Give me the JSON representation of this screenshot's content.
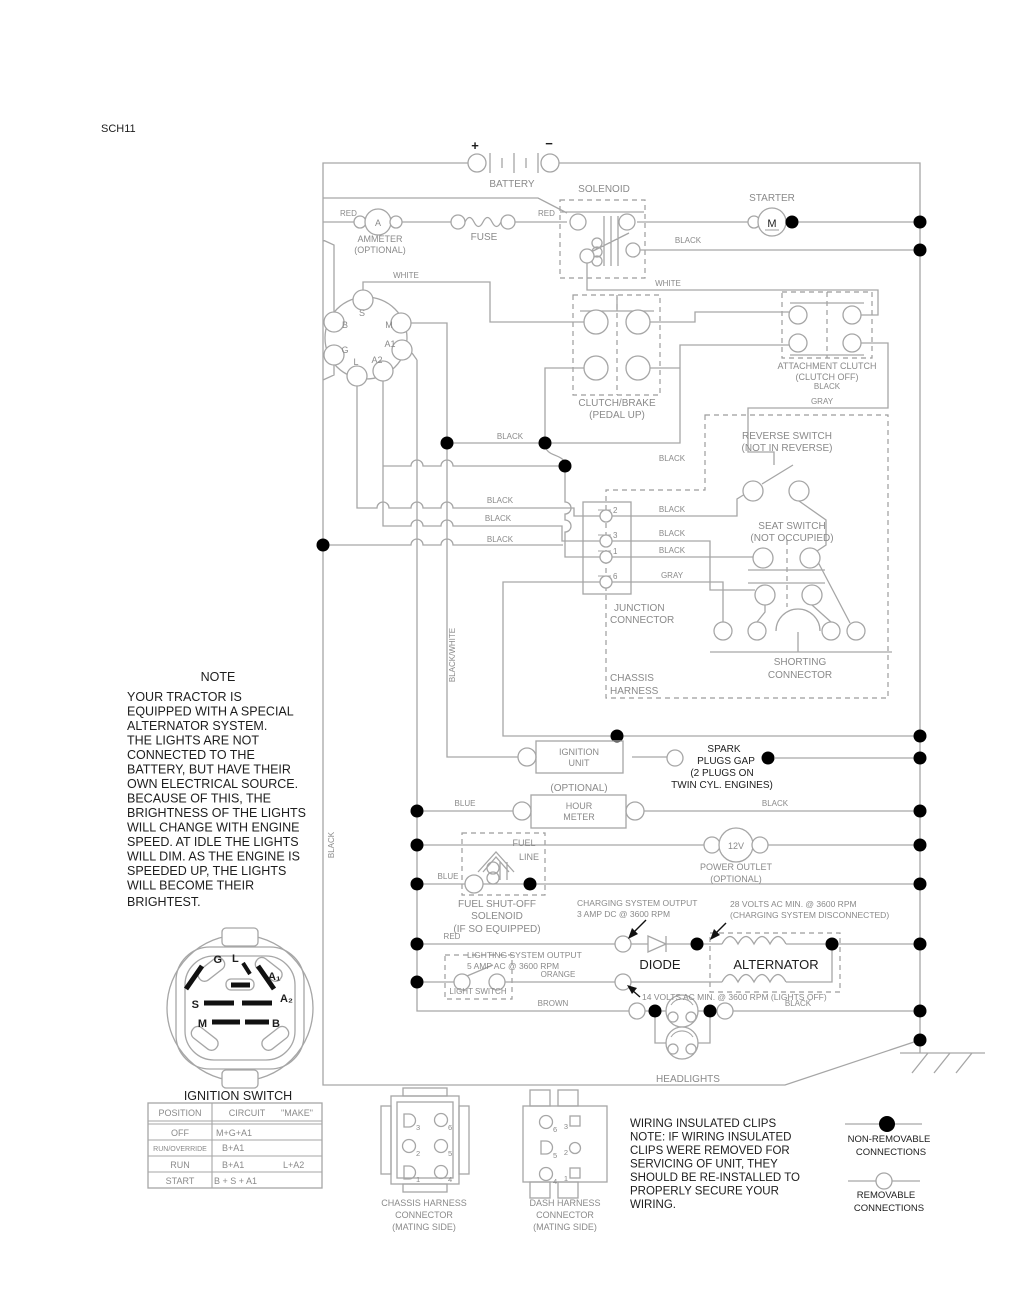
{
  "doc": {
    "sheet": "SCH11"
  },
  "colors": {
    "wire": "#a6a6a6",
    "label_gray": "#8a8a8a",
    "text_black": "#1d1d1d",
    "connection_dot": "#000000"
  },
  "labels": {
    "battery": "BATTERY",
    "battery_plus": "+",
    "battery_minus": "−",
    "solenoid": "SOLENOID",
    "starter": "STARTER",
    "starter_symbol": "M",
    "ammeter1": "AMMETER",
    "ammeter2": "(OPTIONAL)",
    "ammeter_symbol": "A",
    "fuse": "FUSE",
    "clutch1": "CLUTCH/BRAKE",
    "clutch2": "(PEDAL UP)",
    "attach1": "ATTACHMENT CLUTCH",
    "attach2": "(CLUTCH OFF)",
    "reverse1": "REVERSE SWITCH",
    "reverse2": "(NOT IN REVERSE)",
    "seat1": "SEAT SWITCH",
    "seat2": "(NOT OCCUPIED)",
    "junction1": "JUNCTION",
    "junction2": "CONNECTOR",
    "chassis1": "CHASSIS",
    "chassis2": "HARNESS",
    "shorting1": "SHORTING",
    "shorting2": "CONNECTOR",
    "ignition_unit1": "IGNITION",
    "ignition_unit2": "UNIT",
    "spark1": "SPARK",
    "spark2": "PLUGS GAP",
    "spark3": "(2 PLUGS ON",
    "spark4": "TWIN CYL. ENGINES)",
    "hour0": "(OPTIONAL)",
    "hour1": "HOUR",
    "hour2": "METER",
    "fuel1": "FUEL",
    "fuel2": "LINE",
    "fuelsol1": "FUEL SHUT-OFF",
    "fuelsol2": "SOLENOID",
    "fuelsol3": "(IF SO EQUIPPED)",
    "outlet_symbol": "12V",
    "outlet1": "POWER OUTLET",
    "outlet2": "(OPTIONAL)",
    "diode": "DIODE",
    "alternator": "ALTERNATOR",
    "light_switch": "LIGHT SWITCH",
    "headlights": "HEADLIGHTS",
    "ignition_switch": "IGNITION SWITCH"
  },
  "annotations": {
    "charging1": "CHARGING SYSTEM OUTPUT",
    "charging2": "3 AMP DC @ 3600 RPM",
    "volts28_1": "28 VOLTS AC MIN. @ 3600 RPM",
    "volts28_2": "(CHARGING SYSTEM DISCONNECTED)",
    "lighting1": "LIGHTING SYSTEM OUTPUT",
    "lighting2": "5 AMP AC @ 3600 RPM",
    "volts14": "14 VOLTS AC MIN. @ 3600 RPM (LIGHTS OFF)"
  },
  "wire_labels": {
    "red1": "RED",
    "red2": "RED",
    "black_solenoid": "BLACK",
    "white_left": "WHITE",
    "white_right": "WHITE",
    "black_attach": "BLACK",
    "gray_attach": "GRAY",
    "black_row443": "BLACK",
    "black_row466": "BLACK",
    "black_row508L": "BLACK",
    "black_row508R": "BLACK",
    "black_row526L": "BLACK",
    "black_row526R": "BLACK",
    "black_row545L": "BLACK",
    "black_row545R": "BLACK",
    "gray_pin6": "GRAY",
    "black_white_vert": "BLACK/WHITE",
    "black_vert": "BLACK",
    "blue_hour": "BLUE",
    "black_hour": "BLACK",
    "blue_fuel": "BLUE",
    "red_charge": "RED",
    "orange": "ORANGE",
    "brown": "BROWN",
    "black_head": "BLACK"
  },
  "ignition_top": {
    "s": "S",
    "b": "B",
    "m": "M",
    "a1": "A1",
    "g": "G",
    "a2": "A2",
    "l": "L"
  },
  "junction_pins": {
    "p2": "2",
    "p3": "3",
    "p1": "1",
    "p6": "6"
  },
  "ignition_bottom": {
    "g": "G",
    "l": "L",
    "a1": "A₁",
    "a2": "A₂",
    "s": "S",
    "m": "M",
    "b": "B"
  },
  "note": {
    "title": "NOTE",
    "lines": [
      "YOUR TRACTOR IS",
      "EQUIPPED WITH A SPECIAL",
      "ALTERNATOR SYSTEM.",
      "THE LIGHTS ARE NOT",
      "CONNECTED TO THE",
      "BATTERY, BUT HAVE THEIR",
      "OWN ELECTRICAL SOURCE.",
      "BECAUSE OF THIS, THE",
      "BRIGHTNESS OF THE LIGHTS",
      "WILL CHANGE WITH ENGINE",
      "SPEED.  AT IDLE THE LIGHTS",
      "WILL DIM.  AS THE ENGINE IS",
      "SPEEDED UP, THE LIGHTS",
      "WILL BECOME THEIR",
      "BRIGHTEST."
    ]
  },
  "table": {
    "h_position": "POSITION",
    "h_circuit": "CIRCUIT",
    "h_make": "\"MAKE\"",
    "rows": [
      {
        "position": "OFF",
        "make": "M+G+A1",
        "make2": ""
      },
      {
        "position": "RUN/OVERRIDE",
        "make": "B+A1",
        "make2": ""
      },
      {
        "position": "RUN",
        "make": "B+A1",
        "make2": "L+A2"
      },
      {
        "position": "START",
        "make": "B + S + A1",
        "make2": ""
      }
    ]
  },
  "connectors": {
    "chassis1": "CHASSIS HARNESS",
    "chassis2": "CONNECTOR",
    "chassis3": "(MATING SIDE)",
    "dash1": "DASH HARNESS",
    "dash2": "CONNECTOR",
    "dash3": "(MATING SIDE)",
    "chassis_pins": {
      "n3": "3",
      "n2": "2",
      "n1": "1",
      "n6": "6",
      "n5": "5",
      "n4": "4"
    },
    "dash_pins": {
      "n6": "6",
      "n5": "5",
      "n4": "4",
      "n3": "3",
      "n2": "2",
      "n1": "1"
    }
  },
  "clips_note": {
    "lines": [
      "WIRING INSULATED CLIPS",
      "NOTE: IF WIRING INSULATED",
      "CLIPS WERE REMOVED FOR",
      "SERVICING OF UNIT, THEY",
      "SHOULD BE RE-INSTALLED TO",
      "PROPERLY SECURE YOUR",
      "WIRING."
    ]
  },
  "legend": {
    "nonremovable1": "NON-REMOVABLE",
    "nonremovable2": "CONNECTIONS",
    "removable1": "REMOVABLE",
    "removable2": "CONNECTIONS"
  }
}
